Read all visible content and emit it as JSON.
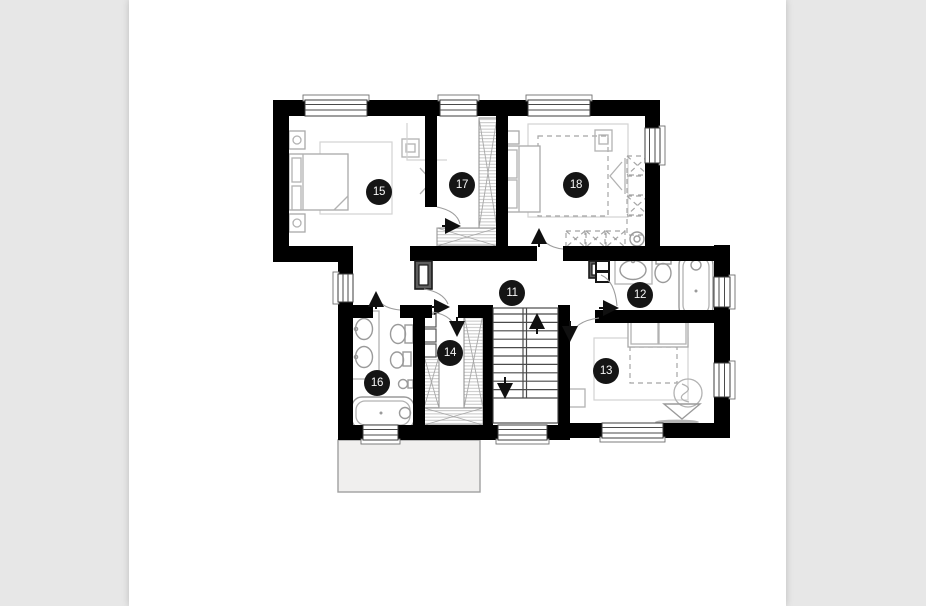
{
  "document": {
    "kind": "floor-plan-drawing",
    "sheet_color": "#ffffff",
    "canvas_color": "#e7e7e7"
  },
  "floor_plan": {
    "marker_radius": 13,
    "colors": {
      "wall": "#646464",
      "wall_outline": "#191919",
      "furniture": "#b2b2b2",
      "marker_bg": "#151515",
      "marker_text": "#f7f7f7"
    },
    "rooms": [
      {
        "number": "11",
        "type": "hallway",
        "cx": 512,
        "cy": 293
      },
      {
        "number": "12",
        "type": "bathroom",
        "cx": 640,
        "cy": 295
      },
      {
        "number": "13",
        "type": "bedroom",
        "cx": 606,
        "cy": 371
      },
      {
        "number": "14",
        "type": "walk-in-closet",
        "cx": 450,
        "cy": 353
      },
      {
        "number": "15",
        "type": "bedroom",
        "cx": 379,
        "cy": 192
      },
      {
        "number": "16",
        "type": "bathroom",
        "cx": 377,
        "cy": 383
      },
      {
        "number": "17",
        "type": "walk-in-closet",
        "cx": 462,
        "cy": 185
      },
      {
        "number": "18",
        "type": "bedroom",
        "cx": 576,
        "cy": 185
      }
    ]
  }
}
